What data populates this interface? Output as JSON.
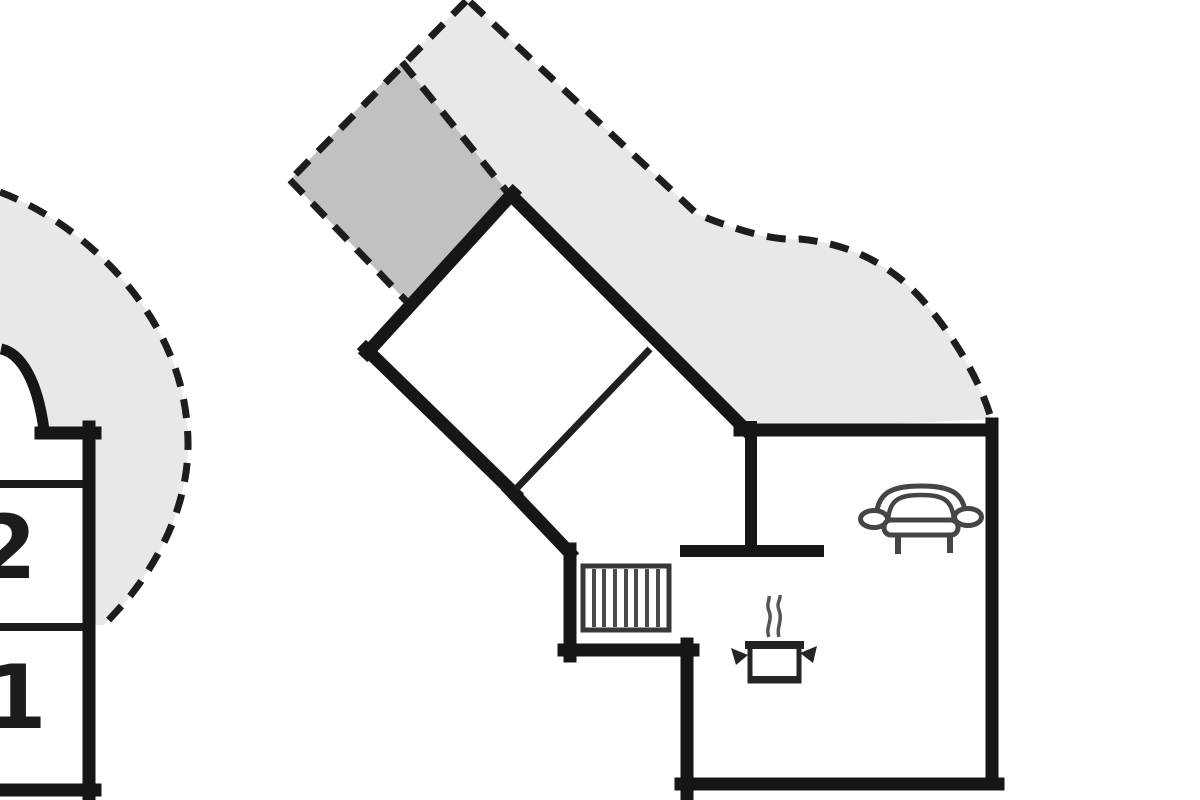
{
  "plan": {
    "rooms": {
      "left_building": [
        {
          "label": "2"
        },
        {
          "label": "1"
        }
      ]
    },
    "icons": [
      "door-swing-icon",
      "staircase-icon",
      "sofa-icon",
      "cooking-pot-icon"
    ],
    "colors": {
      "background": "#ffffff",
      "wall": "#161616",
      "dashed_boundary": "#1d1d1d",
      "terrace_light": "#e8e8e8",
      "terrace_dark": "#c1c1c1",
      "furniture_stroke": "#454545"
    }
  }
}
